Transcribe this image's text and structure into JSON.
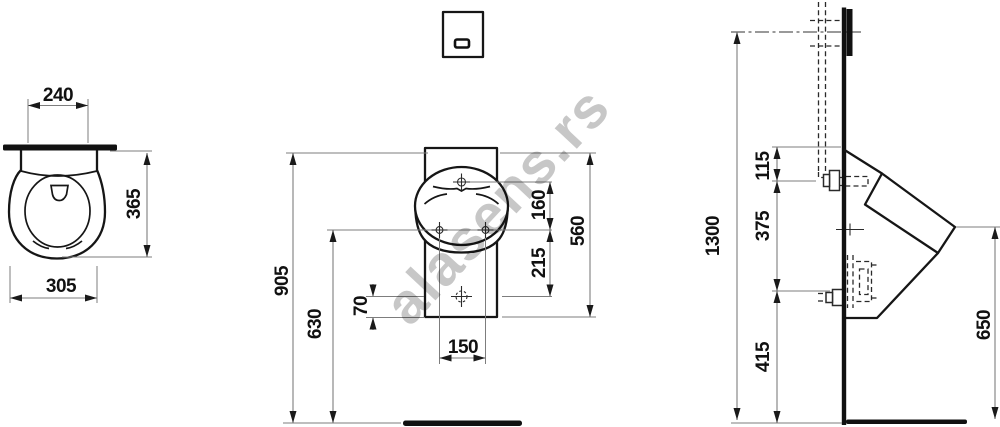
{
  "watermark": {
    "text": "alasens.rs"
  },
  "views": {
    "top_view": {
      "dims": {
        "fixing_width": "240",
        "depth": "365",
        "width": "305"
      }
    },
    "front_view": {
      "dims": {
        "overall_height": "905",
        "floor_to_outlet": "630",
        "outlet_to_bottom_edge": "70",
        "bottom_hole_spacing": "150",
        "inlet_to_side_holes": "160",
        "side_holes_to_outlet": "215",
        "ceramic_height": "560"
      }
    },
    "side_view": {
      "dims": {
        "flush_unit_height": "1300",
        "rim_to_inlet": "115",
        "inlet_to_outlet": "375",
        "outlet_to_floor": "415",
        "rim_front_height": "650"
      }
    }
  }
}
